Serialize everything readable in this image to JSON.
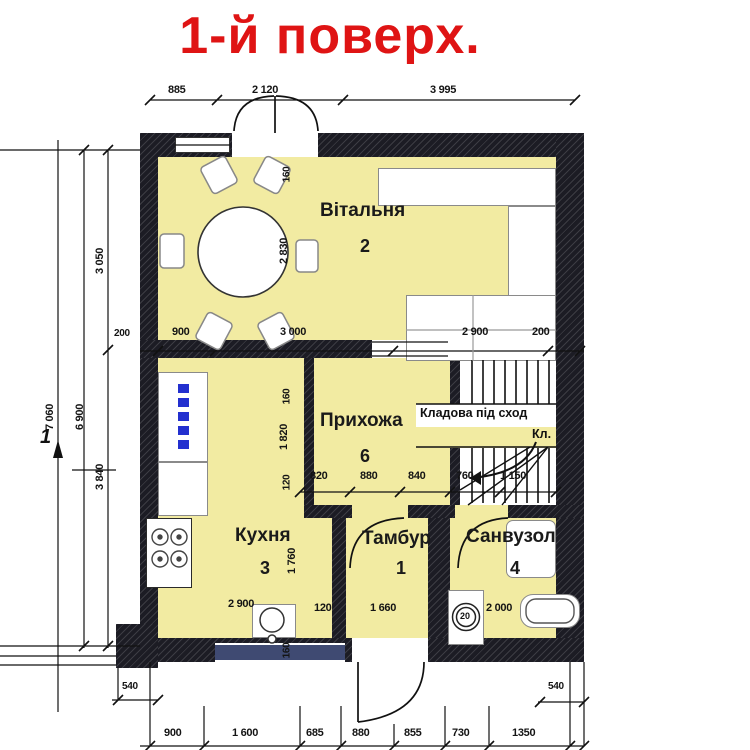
{
  "title": "1-й поверх.",
  "rooms": {
    "living": {
      "name": "Вітальня",
      "number": "2"
    },
    "hallway": {
      "name": "Прихожа",
      "number": "6"
    },
    "closet": {
      "line1": "Кладова під сход",
      "line2": "Кл."
    },
    "kitchen": {
      "name": "Кухня",
      "number": "3"
    },
    "vestibule": {
      "name": "Тамбур",
      "number": "1"
    },
    "bathroom": {
      "name": "Санвузол",
      "number": "4"
    }
  },
  "dims": {
    "top": [
      "885",
      "2 120",
      "3 995"
    ],
    "mid": [
      "200",
      "900",
      "3 000",
      "2 900",
      "200"
    ],
    "hall": [
      "820",
      "880",
      "840",
      "760",
      "1 150"
    ],
    "bottom": [
      "900",
      "1 600",
      "685",
      "880",
      "855",
      "730",
      "1350"
    ],
    "left": {
      "outer": "7 060",
      "inner": "6 900",
      "upper": "3 050",
      "lower": "3 840"
    },
    "col": [
      "160",
      "2 830",
      "160",
      "1 820",
      "120",
      "1 760",
      "160"
    ],
    "kitchen_width": "2 900",
    "wall_thickness": "120",
    "vestibule_width": "1 660",
    "bathroom_width": "2 000",
    "drain": "20",
    "offset_left": "540",
    "offset_right": "540",
    "axis": "1"
  },
  "colors": {
    "room-fill": "#f2eba2",
    "wall": "#1c1c24",
    "title": "#df1414",
    "glyph-blue": "#2330cf",
    "window-blue": "#3f4a72"
  }
}
